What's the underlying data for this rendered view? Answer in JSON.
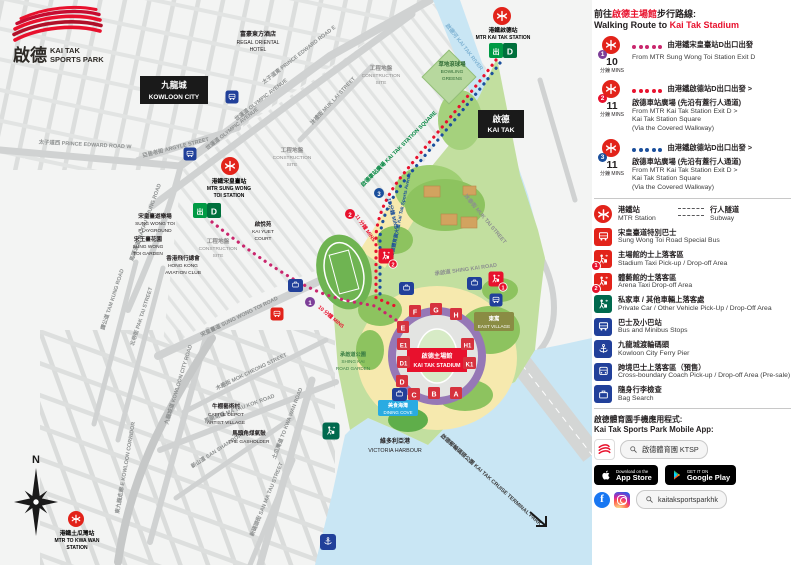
{
  "colors": {
    "ktsp_red": "#e8112d",
    "mtr_red": "#e2231a",
    "route1_dots": "#c9266d",
    "route1_badge": "#7d3f98",
    "route2": "#e8112d",
    "route3": "#1b4f9c",
    "exit_green": "#009a44",
    "icon_blue": "#21409a",
    "icon_green": "#00694e",
    "dining_cove": "#29abe2",
    "east_village": "#8a8c44",
    "stadium_ring": "#9678b6",
    "water": "#c9e6f4",
    "park_green": "#c2df9f"
  },
  "map": {
    "logo": {
      "zh": "啟德",
      "en1": "KAI TAK",
      "en2": "SPORTS PARK"
    },
    "boxes": {
      "kowloon_city_zh": "九龍城",
      "kowloon_city_en": "KOWLOON CITY",
      "kai_tak_zh": "啟德",
      "kai_tak_en": "KAI TAK"
    },
    "roads": {
      "pe_w": "太子道西 PRINCE EDWARD ROAD W",
      "argyle": "亞皆老街 ARGYLE STREET",
      "pe_e": "太子道東 PRINCE EDWARD ROAD E",
      "olympic1": "世運道 OLYMPIC AVENUE",
      "olympic2": "世運道 OLYMPIC AVENUE",
      "muk_lai": "沐禮街 MUK LAI STREET",
      "ma_tau_chung": "馬頭涌道 MA TAU CHUNG ROAD",
      "tam_kung": "譚公道 TAM KUNG ROAD",
      "pak_tai": "北帝街 PAK TAI STREET",
      "swt": "宋皇臺道 SUNG WONG TOI ROAD",
      "mok_cheong": "木廠街 MOK CHEONG STREET",
      "kc_road": "九龍城道 KOWLOON CITY ROAD",
      "e_kowloon": "東九龍走廊 E KOWLOON CORRIDOR",
      "san_shan": "新山道 SAN SHAN ROAD",
      "san_ma_tau": "新碼頭街 SAN MA TAU STREET",
      "ma_tau_kok": "馬頭角道 MA TAU KOK ROAD",
      "to_kwa_wan": "土瓜灣道 TO KWA WAN ROAD",
      "shing_kai": "承啟道 SHING KAI ROAD",
      "muk_tai": "沐泰街 MUK TAI STREET",
      "station_sq": "啟德車站廣場 KAI TAK STATION SQUARE",
      "sports_ave": "啟德體育園大道 Kai Tak Sports Avenue",
      "river": "啟德河 KAI TAK RIVER",
      "cruise": "啟德郵輪碼頭公園 KAI TAK CRUISE TERMINAL PARK"
    },
    "places": {
      "regal": [
        "富豪東方酒店",
        "REGAL ORIENTAL",
        "HOTEL"
      ],
      "cs": [
        "工程地盤",
        "CONSTRUCTION",
        "SITE"
      ],
      "kai_yuet": [
        "啟悅苑",
        "KAI YUET",
        "COURT"
      ],
      "swt_pg": [
        "宋皇臺遊樂場",
        "SUNG WONG TOI",
        "PLAYGROUND"
      ],
      "swt_gd": [
        "宋王臺花園",
        "SUNG WONG",
        "TOI GARDEN"
      ],
      "aviation": [
        "香港飛行總會",
        "HONG KONG",
        "AVIATION CLUB"
      ],
      "bowling": [
        "草地滾球場",
        "BOWLING",
        "GREENS"
      ],
      "cattle": [
        "牛棚藝術村",
        "CATTLE DEPOT",
        "ARTIST VILLAGE"
      ],
      "gasholder": [
        "馬頭角煤氣鼓",
        "THE GASHOLDER"
      ],
      "skr_gd": [
        "承啟道公園",
        "SHING KAI",
        "ROAD GARDEN"
      ],
      "east_village": [
        "東寓",
        "EAST VILLAGE"
      ],
      "dining": [
        "美食海灣",
        "DINING COVE"
      ],
      "victoria": [
        "維多利亞港",
        "VICTORIA HARBOUR"
      ]
    },
    "stations": {
      "swt": [
        "港鐵宋皇臺站",
        "MTR SUNG WONG",
        "TOI STATION"
      ],
      "kt": [
        "港鐵啟德站",
        "MTR KAI TAK STATION"
      ],
      "tkw": [
        "港鐵土瓜灣站",
        "MTR TO KWA WAN",
        "STATION"
      ],
      "exit_zh": "出",
      "exit_letter": "D"
    },
    "stadium": {
      "label": [
        "啟德主場館",
        "KAI TAK STADIUM"
      ],
      "gates": [
        "F",
        "G",
        "H",
        "E",
        "E1",
        "D1",
        "D",
        "C",
        "B",
        "A",
        "H1",
        "K1"
      ]
    },
    "route_marks": {
      "r1_num": "1",
      "r2_num": "2",
      "r3_num": "3",
      "r1_label": "10 分鐘 MINS",
      "r2_label": "11 分鐘 MINS",
      "r3_label": "11 分鐘 MINS",
      "taxi1_num": "1",
      "taxi2_num": "2"
    },
    "compass_n": "N"
  },
  "sidebar": {
    "title": {
      "zh_pre": "前往",
      "zh_red": "啟德主場館",
      "zh_post": "步行路線:",
      "en_pre": "Walking Route to ",
      "en_red": "Kai Tak Stadium"
    },
    "routes": [
      {
        "num": "1",
        "mins": "10",
        "mins_label": "分鐘 MINS",
        "zh": [
          "由港鐵宋皇臺站D出口出發"
        ],
        "en": [
          "From MTR Sung Wong Toi Station Exit D"
        ]
      },
      {
        "num": "2",
        "mins": "11",
        "mins_label": "分鐘 MINS",
        "zh": [
          "由港鐵啟德站D出口出發 >",
          "啟德車站廣場 (先沿有蓋行人通道)"
        ],
        "en": [
          "From MTR Kai Tak Station Exit D >",
          "Kai Tak Station Square",
          "(Via the Covered Walkway)"
        ]
      },
      {
        "num": "3",
        "mins": "11",
        "mins_label": "分鐘 MINS",
        "zh": [
          "由港鐵啟德站D出口出發 >",
          "啟德車站廣場 (先沿有蓋行人通道)"
        ],
        "en": [
          "From MTR Kai Tak Station Exit D >",
          "Kai Tak Station Square",
          "(Via the Covered Walkway)"
        ]
      }
    ],
    "legend": [
      {
        "zh": "港鐵站",
        "en": "MTR Station",
        "zh2": "行人隧道",
        "en2": "Subway"
      },
      {
        "zh": "宋皇臺道特別巴士",
        "en": "Sung Wong Toi Road Special Bus"
      },
      {
        "zh": "主場館的士上落客區",
        "en": "Stadium Taxi Pick-up / Drop-off Area",
        "badge": "1"
      },
      {
        "zh": "體藝館的士落客區",
        "en": "Arena Taxi Drop-off Area",
        "badge": "2"
      },
      {
        "zh": "私家車 / 其他車輛上落客處",
        "en": "Private Car / Other Vehicle Pick-Up / Drop-Off Area"
      },
      {
        "zh": "巴士及小巴站",
        "en": "Bus and Minibus Stops"
      },
      {
        "zh": "九龍城渡輪碼頭",
        "en": "Kowloon City Ferry Pier"
      },
      {
        "zh": "跨境巴士上落客區（預售）",
        "en": "Cross-boundary Coach Pick-up / Drop-off Area (Pre-sale)"
      },
      {
        "zh": "隨身行李檢查",
        "en": "Bag Search"
      }
    ],
    "app": {
      "zh": "啟德體育園手機應用程式:",
      "en": "Kai Tak Sports Park Mobile App:",
      "search_app": "啟德體育園 KTSP",
      "appstore_top": "Download on the",
      "appstore_main": "App Store",
      "gplay_top": "GET IT ON",
      "gplay_main": "Google Play",
      "search_social": "kaitaksportsparkhk"
    }
  }
}
